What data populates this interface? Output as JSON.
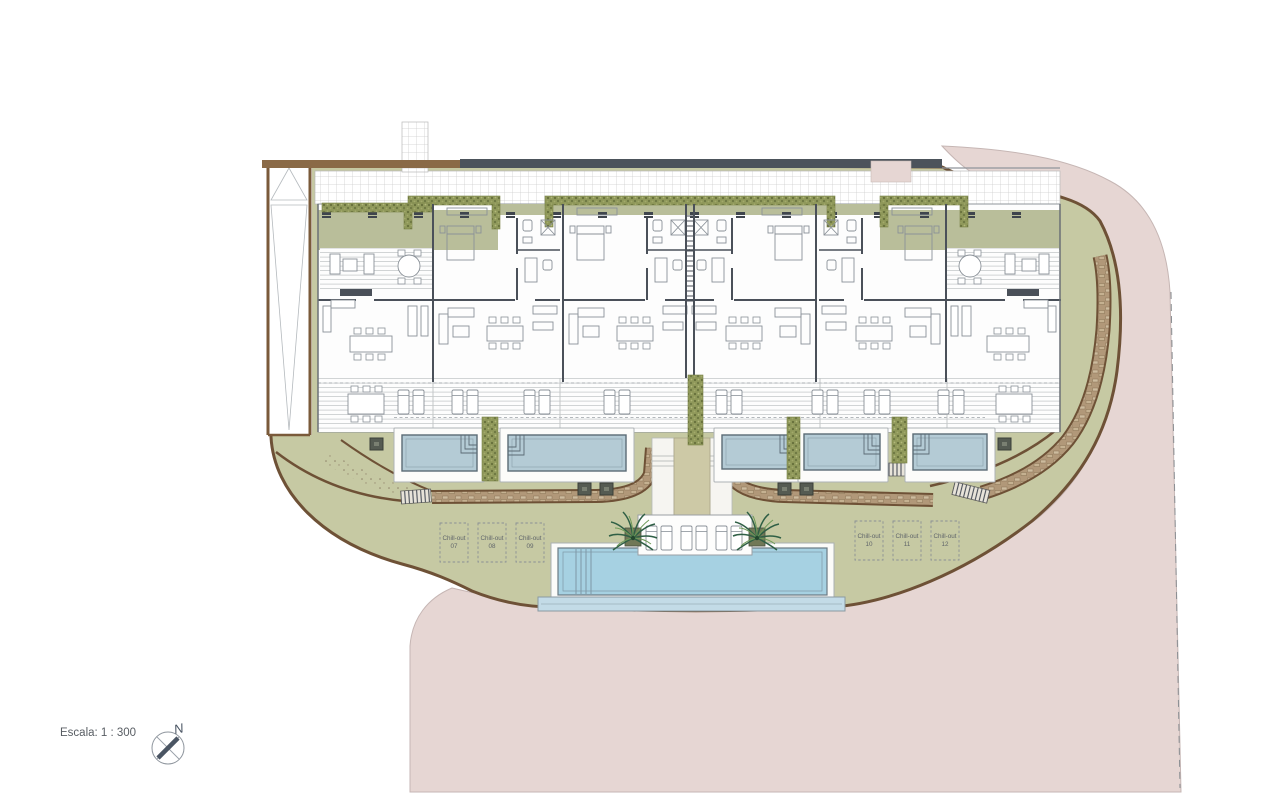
{
  "annotations": {
    "scale_label": "Escala: 1 : 300",
    "north_letter": "N"
  },
  "chill_outs": [
    {
      "label": "Chill-out",
      "number": "07"
    },
    {
      "label": "Chill-out",
      "number": "08"
    },
    {
      "label": "Chill-out",
      "number": "09"
    },
    {
      "label": "Chill-out",
      "number": "10"
    },
    {
      "label": "Chill-out",
      "number": "11"
    },
    {
      "label": "Chill-out",
      "number": "12"
    }
  ],
  "colors": {
    "surround_pink": "#e6d6d3",
    "landscape_green": "#c6c9a3",
    "roof_band": "#b9be9a",
    "hedge_green": "#8f985a",
    "wall_brown": "#6e5136",
    "path_brown": "#8a6a47",
    "stone_tan": "#b19879",
    "pool_water": "#b4cbd5",
    "main_pool_water": "#a6d1e2",
    "overflow_blue": "#c3dbe7",
    "canopy_dark": "#4c535b",
    "interior_wall": "#4a5059",
    "furniture_gray": "#8a9198",
    "walkway_tan": "#cdc9a6",
    "text_gray": "#585d63"
  }
}
